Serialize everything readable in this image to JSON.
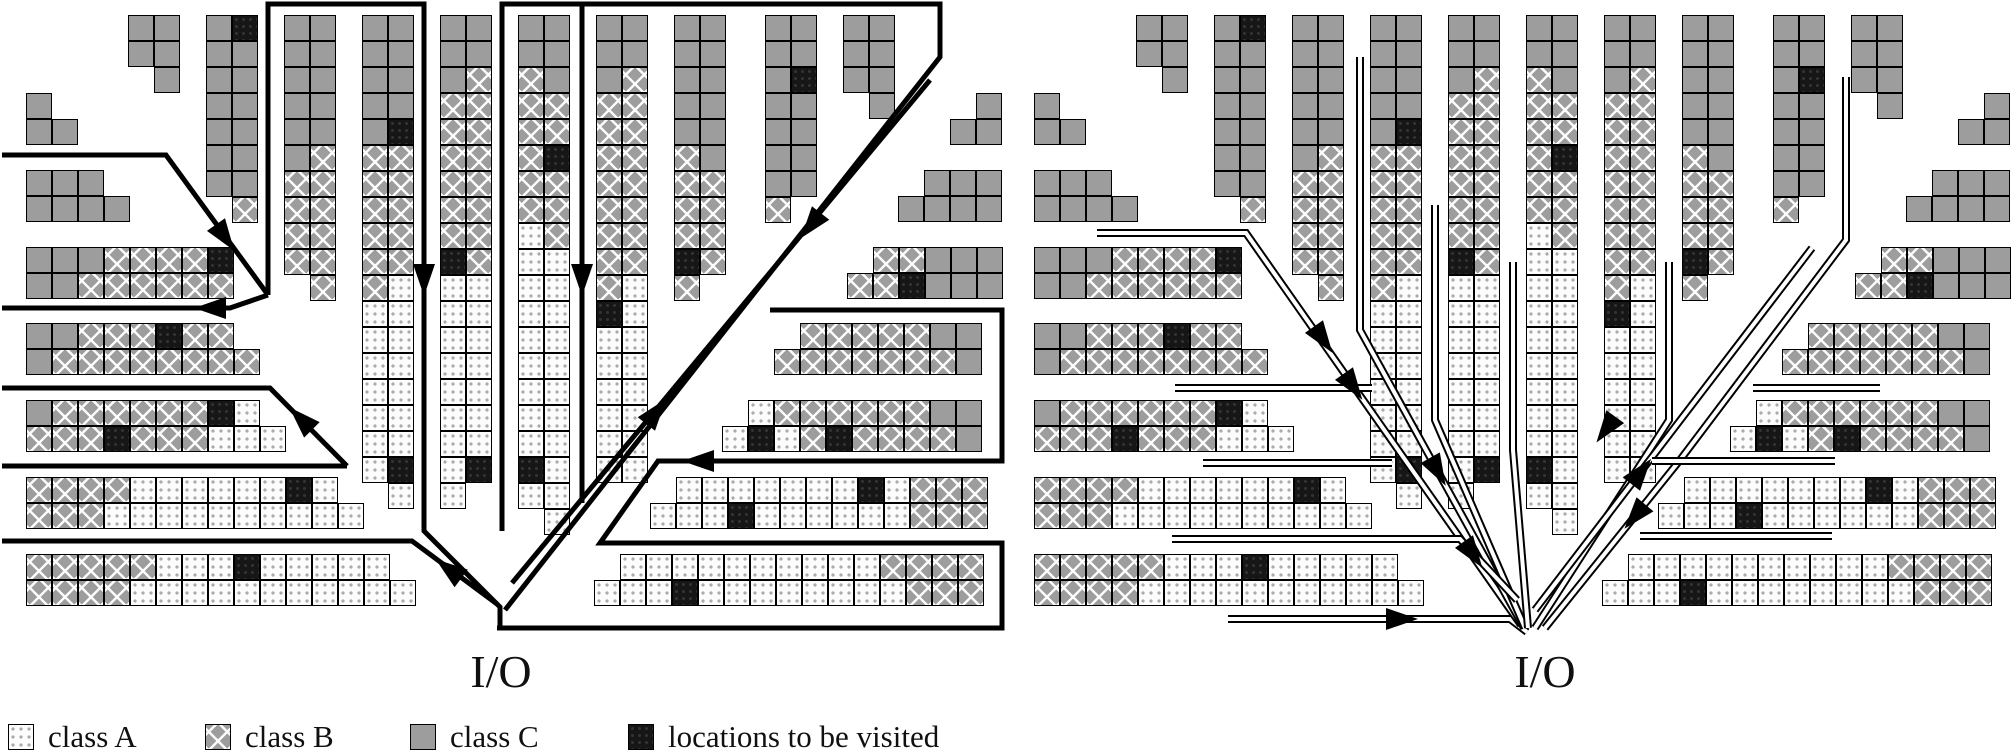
{
  "legend": {
    "items": [
      {
        "class_key": "A",
        "label": "class A"
      },
      {
        "class_key": "B",
        "label": "class B"
      },
      {
        "class_key": "C",
        "label": "class C"
      },
      {
        "class_key": "V",
        "label": "locations to be visited"
      }
    ]
  },
  "colors": {
    "class_a_fill": "#fcfcfc",
    "class_b_fill": "#9d9d9d",
    "class_c_fill": "#9d9d9d",
    "visited_fill": "#161616",
    "route_stroke": "#000000",
    "channel_inner": "#ffffff"
  },
  "cell_size": 26,
  "blocks": [
    {
      "x": 128,
      "y": 15,
      "rows": [
        "CC",
        "CC",
        ".C"
      ]
    },
    {
      "x": 206,
      "y": 15,
      "rows": [
        "CV",
        "CC",
        "CC",
        "CC",
        "CC",
        "CC",
        "CC",
        ".B"
      ]
    },
    {
      "x": 284,
      "y": 15,
      "rows": [
        "CC",
        "CC",
        "CC",
        "CC",
        "CC",
        "CB",
        "BB",
        "BB",
        "BB",
        "BB",
        ".B"
      ]
    },
    {
      "x": 362,
      "y": 15,
      "rows": [
        "CC",
        "CC",
        "CC",
        "CC",
        "CV",
        "BB",
        "BB",
        "BB",
        "BB",
        "BB",
        "BA",
        "AA",
        "AA",
        "AA",
        "AA",
        "AA",
        "AA",
        "AV",
        ".A"
      ]
    },
    {
      "x": 440,
      "y": 15,
      "rows": [
        "CC",
        "CC",
        "CB",
        "BB",
        "BB",
        "BB",
        "BB",
        "BB",
        "BB",
        "VB",
        "AA",
        "AA",
        "AA",
        "AA",
        "AA",
        "AA",
        "AA",
        "AV",
        "A."
      ]
    },
    {
      "x": 518,
      "y": 15,
      "rows": [
        "CC",
        "CC",
        "BC",
        "BB",
        "BB",
        "BV",
        "BB",
        "BB",
        "AB",
        "AA",
        "AA",
        "AA",
        "AA",
        "AA",
        "AA",
        "AA",
        "AA",
        "VA",
        "AA",
        ".A"
      ]
    },
    {
      "x": 596,
      "y": 15,
      "rows": [
        "CC",
        "CC",
        "CB",
        "BB",
        "BB",
        "BB",
        "BB",
        "BB",
        "BB",
        "BB",
        "BA",
        "VA",
        "AA",
        "AA",
        "AA",
        "AA",
        "AA",
        "AA"
      ]
    },
    {
      "x": 674,
      "y": 15,
      "rows": [
        "CC",
        "CC",
        "CC",
        "CC",
        "CC",
        "BC",
        "BB",
        "BB",
        "BB",
        "VB",
        "B."
      ]
    },
    {
      "x": 765,
      "y": 15,
      "rows": [
        "CC",
        "CC",
        "CV",
        "CC",
        "CC",
        "CC",
        "CC",
        "B."
      ]
    },
    {
      "x": 843,
      "y": 15,
      "rows": [
        "CC",
        "CC",
        "CC",
        ".C"
      ]
    },
    {
      "x": 950,
      "y": 93,
      "rows": [
        ".C",
        "CC"
      ]
    },
    {
      "x": 898,
      "y": 170,
      "rows": [
        ".CCC",
        "CCCC"
      ]
    },
    {
      "x": 26,
      "y": 93,
      "rows": [
        "C.",
        "CC"
      ]
    },
    {
      "x": 26,
      "y": 170,
      "rows": [
        "CCC.",
        "CCCC"
      ]
    },
    {
      "x": 26,
      "y": 247,
      "rows": [
        "CCCBBBBV",
        "CCBBBBBB"
      ]
    },
    {
      "x": 26,
      "y": 323,
      "rows": [
        "CCBBBVBB.",
        "CBBBBBBBB"
      ]
    },
    {
      "x": 26,
      "y": 400,
      "rows": [
        "CBBBBBBVA.",
        "BBBVBBBAAA"
      ]
    },
    {
      "x": 26,
      "y": 477,
      "rows": [
        "BBBBAAAAAAVA.",
        "BBBAAAAAAAAAA"
      ]
    },
    {
      "x": 26,
      "y": 554,
      "rows": [
        "BBBBBAAAVAAAAA.",
        "BBBBAAAAAAAAAAA"
      ]
    },
    {
      "x": 847,
      "y": 247,
      "rows": [
        ".BBCCC",
        "BBVCCC"
      ]
    },
    {
      "x": 774,
      "y": 323,
      "rows": [
        ".BBBBBCC",
        "BBBBBBBC"
      ]
    },
    {
      "x": 722,
      "y": 400,
      "rows": [
        ".ABBBBBBCC",
        "AVABVBBBBC"
      ]
    },
    {
      "x": 650,
      "y": 477,
      "rows": [
        ".AAAAAAAVABBB",
        "AAAVAAAAAABBB"
      ]
    },
    {
      "x": 594,
      "y": 554,
      "rows": [
        ".AAAAAAAAAABBBB",
        "AAAVAAAAAAAABBB"
      ]
    }
  ],
  "diagrams": [
    {
      "io_label": "I/O",
      "io_center_x": 501,
      "io_top_y": 645,
      "offset_x": 0,
      "route_style": "solid",
      "routes": [
        [
          [
            2,
            155
          ],
          [
            166,
            155
          ],
          [
            268,
            295
          ]
        ],
        [
          [
            268,
            295
          ],
          [
            230,
            308
          ],
          [
            2,
            308
          ]
        ],
        [
          [
            268,
            295
          ],
          [
            268,
            4
          ],
          [
            424,
            4
          ],
          [
            424,
            531
          ],
          [
            500,
            607
          ],
          [
            500,
            628
          ]
        ],
        [
          [
            502,
            531
          ],
          [
            502,
            4
          ],
          [
            582,
            4
          ],
          [
            582,
            503
          ]
        ],
        [
          [
            582,
            4
          ],
          [
            940,
            4
          ],
          [
            940,
            57
          ],
          [
            505,
            610
          ]
        ],
        [
          [
            930,
            80
          ],
          [
            512,
            583
          ]
        ],
        [
          [
            2,
            388
          ],
          [
            270,
            388
          ],
          [
            347,
            466
          ]
        ],
        [
          [
            2,
            466
          ],
          [
            347,
            466
          ]
        ],
        [
          [
            2,
            541
          ],
          [
            412,
            541
          ],
          [
            497,
            604
          ]
        ],
        [
          [
            497,
            628
          ],
          [
            1002,
            628
          ],
          [
            1002,
            543
          ],
          [
            600,
            543
          ],
          [
            658,
            461
          ],
          [
            1002,
            461
          ],
          [
            1002,
            310
          ],
          [
            770,
            310
          ]
        ]
      ],
      "arrows": [
        {
          "x": 224,
          "y": 236,
          "r": 55
        },
        {
          "x": 212,
          "y": 308,
          "r": 180
        },
        {
          "x": 302,
          "y": 420,
          "r": -135
        },
        {
          "x": 424,
          "y": 278,
          "r": 90
        },
        {
          "x": 582,
          "y": 278,
          "r": 90
        },
        {
          "x": 450,
          "y": 570,
          "r": -143
        },
        {
          "x": 655,
          "y": 413,
          "r": -52
        },
        {
          "x": 812,
          "y": 224,
          "r": 128
        },
        {
          "x": 700,
          "y": 461,
          "r": 180
        }
      ]
    },
    {
      "io_label": "I/O",
      "io_center_x": 1545,
      "io_top_y": 645,
      "offset_x": 1008,
      "route_style": "channel",
      "routes": [
        [
          [
            1228,
            619
          ],
          [
            1510,
            619
          ],
          [
            1527,
            632
          ]
        ],
        [
          [
            1097,
            233
          ],
          [
            1246,
            233
          ],
          [
            1521,
            625
          ]
        ],
        [
          [
            1360,
            57
          ],
          [
            1360,
            330
          ],
          [
            1524,
            628
          ]
        ],
        [
          [
            1435,
            205
          ],
          [
            1435,
            420
          ],
          [
            1525,
            628
          ]
        ],
        [
          [
            1513,
            262
          ],
          [
            1513,
            450
          ],
          [
            1528,
            628
          ]
        ],
        [
          [
            1669,
            262
          ],
          [
            1669,
            420
          ],
          [
            1535,
            628
          ]
        ],
        [
          [
            1846,
            77
          ],
          [
            1846,
            240
          ],
          [
            1680,
            460
          ],
          [
            1545,
            628
          ]
        ],
        [
          [
            1812,
            248
          ],
          [
            1535,
            610
          ]
        ],
        [
          [
            1175,
            388
          ],
          [
            1372,
            388
          ]
        ],
        [
          [
            1203,
            463
          ],
          [
            1392,
            463
          ]
        ],
        [
          [
            1172,
            539
          ],
          [
            1460,
            539
          ],
          [
            1517,
            600
          ]
        ],
        [
          [
            1640,
            536
          ],
          [
            1832,
            536
          ]
        ],
        [
          [
            1652,
            461
          ],
          [
            1835,
            461
          ]
        ],
        [
          [
            1753,
            388
          ],
          [
            1880,
            388
          ]
        ]
      ],
      "arrows": [
        {
          "x": 1400,
          "y": 619,
          "r": 0
        },
        {
          "x": 1322,
          "y": 338,
          "r": 55
        },
        {
          "x": 1352,
          "y": 385,
          "r": 55
        },
        {
          "x": 1472,
          "y": 553,
          "r": 55
        },
        {
          "x": 1437,
          "y": 470,
          "r": 61
        },
        {
          "x": 1607,
          "y": 428,
          "r": 126
        },
        {
          "x": 1636,
          "y": 515,
          "r": 130
        },
        {
          "x": 1640,
          "y": 473,
          "r": -52
        }
      ]
    }
  ]
}
